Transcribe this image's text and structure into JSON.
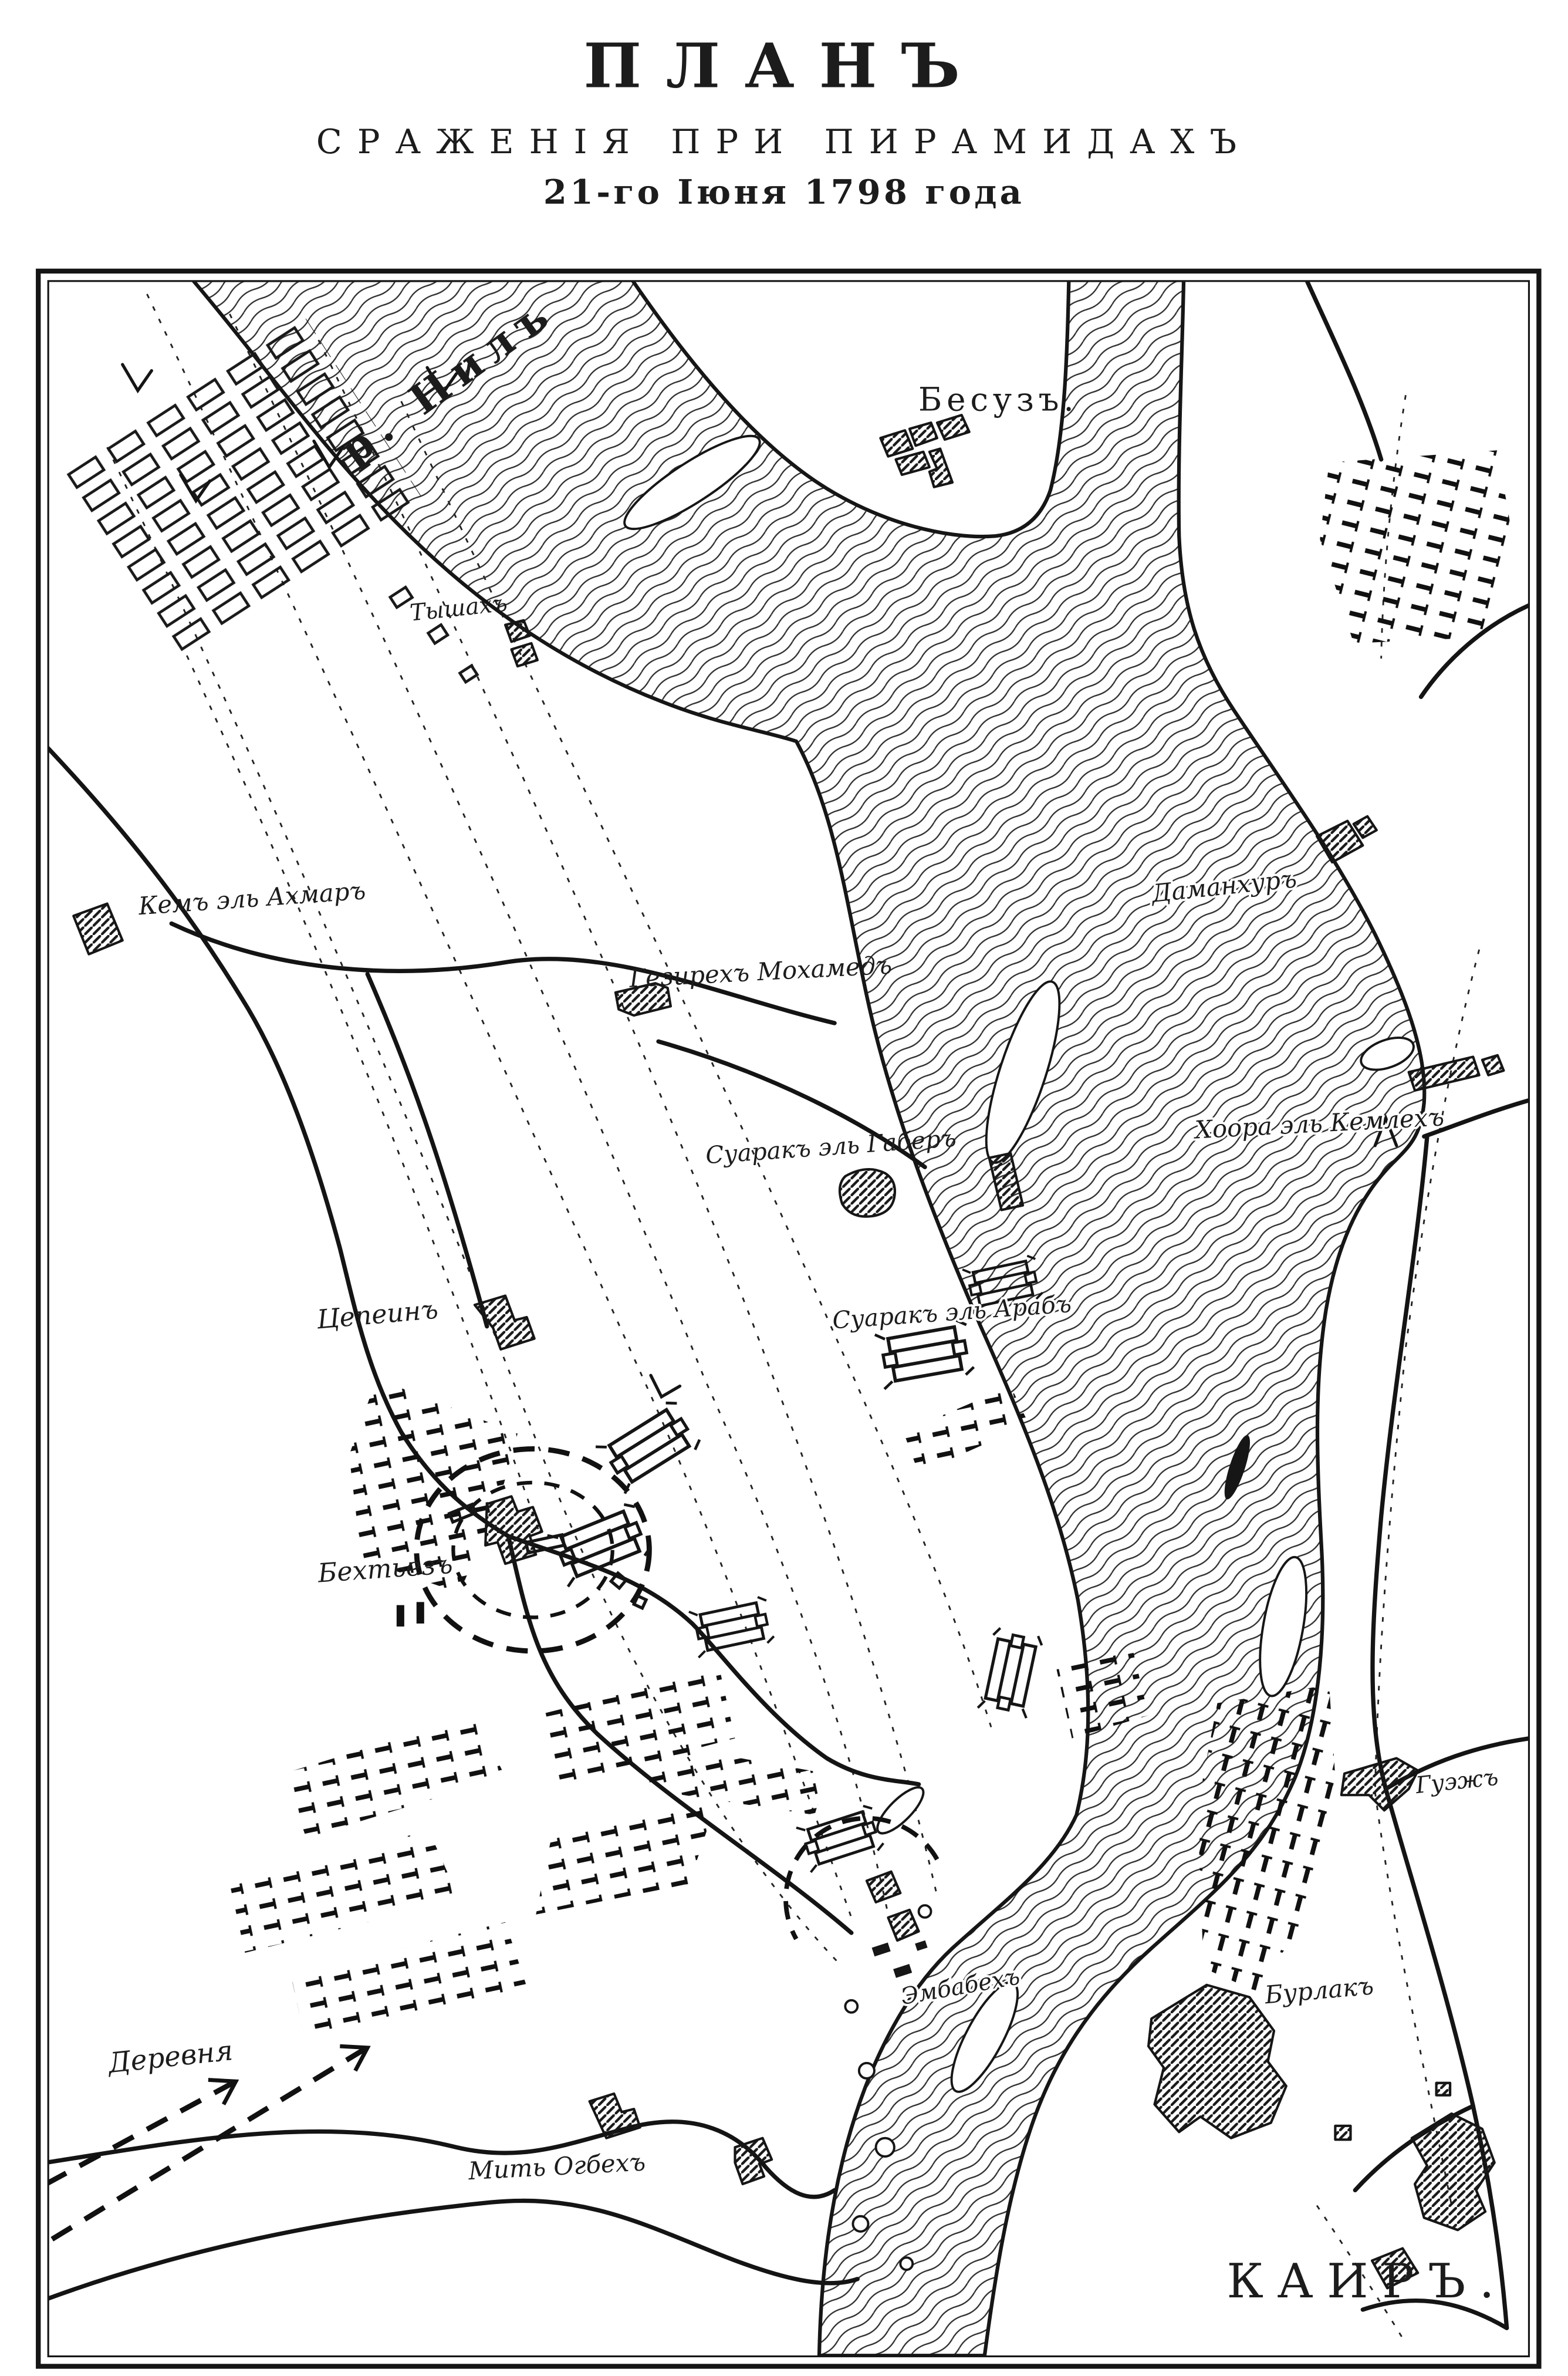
{
  "page": {
    "colors": {
      "ink": "#1c1c1c",
      "paper": "#ffffff"
    }
  },
  "title": {
    "line1": "ПЛАНЪ",
    "line2": "СРАЖЕНІЯ ПРИ ПИРАМИДАХЪ",
    "line3": "21-го Іюня 1798 года"
  },
  "map": {
    "river_label": "р. Нилъ",
    "labels": {
      "besuz": "Бесузъ.",
      "tyshah": "Тышахъ",
      "kem_el_ahmar": "Кемъ эль Ахмаръ",
      "gezireh_mohamed": "Гезирехъ Мохамедъ",
      "damanhur": "Даманхуръ",
      "khoora_el_kemlekh": "Хоора эль Кемлехъ",
      "suarak_el_gaber": "Суаракъ эль Габеръ",
      "suarak_el_arab": "Суаракъ эль Арабъ",
      "tsepein": "Цепеинъ",
      "bekhtyez": "Бехтьезъ",
      "guezh": "Гуэжъ",
      "burlak": "Бурлакъ",
      "embabeh": "Эмбабехъ",
      "derevnya": "Деревня",
      "mit_ogbeh": "Мить Огбехъ",
      "cairo": "КАИРЪ."
    }
  }
}
